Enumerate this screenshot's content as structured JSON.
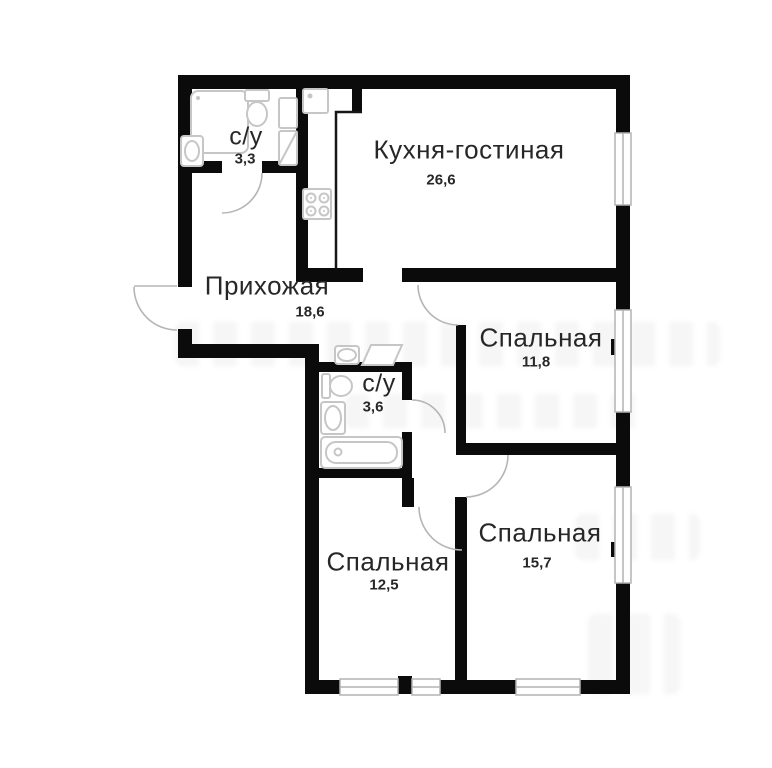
{
  "plan": {
    "rooms": [
      {
        "key": "bathroom-top",
        "label": "с/у",
        "area": "3,3"
      },
      {
        "key": "kitchen-living",
        "label": "Кухня-гостиная",
        "area": "26,6"
      },
      {
        "key": "hallway",
        "label": "Прихожая",
        "area": "18,6"
      },
      {
        "key": "bedroom-right",
        "label": "Спальная",
        "area": "11,8"
      },
      {
        "key": "bathroom-mid",
        "label": "с/у",
        "area": "3,6"
      },
      {
        "key": "bedroom-bottom-left",
        "label": "Спальная",
        "area": "12,5"
      },
      {
        "key": "bedroom-bottom-right",
        "label": "Спальная",
        "area": "15,7"
      }
    ],
    "colors": {
      "wall": "#0b0b0b",
      "fixture": "#c6c6c6",
      "label": "#272727",
      "background": "#ffffff"
    }
  }
}
